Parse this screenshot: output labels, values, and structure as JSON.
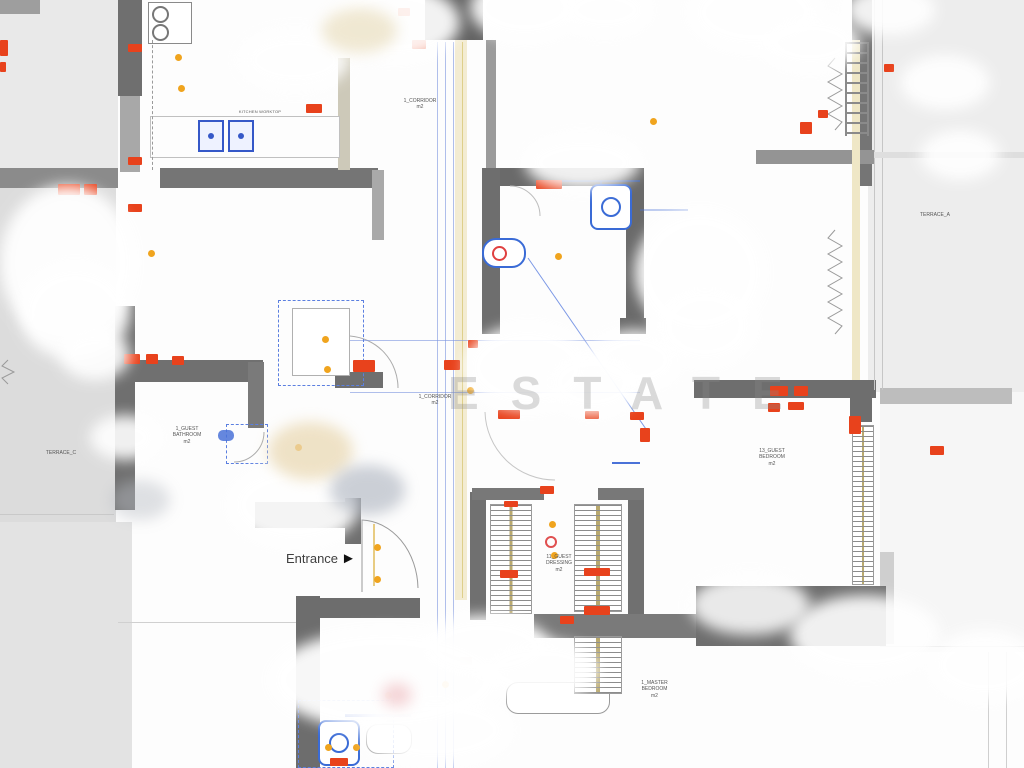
{
  "watermark": "ESTATE",
  "entrance": {
    "label": "Entrance",
    "arrow": "►"
  },
  "labels": {
    "corridor_upper": {
      "l1": "1_CORRIDOR",
      "l2": "m2"
    },
    "corridor_lower": {
      "l1": "1_CORRIDOR",
      "l2": "m2"
    },
    "terrace_a": {
      "l1": "TERRACE_A"
    },
    "terrace_c": {
      "l1": "TERRACE_C"
    },
    "guest_bathroom": {
      "l1": "1_GUEST",
      "l2": "BATHROOM",
      "l3": "m2"
    },
    "guest_bedroom": {
      "l1": "13_GUEST",
      "l2": "BEDROOM",
      "l3": "m2"
    },
    "guest_dressing": {
      "l1": "11_GUEST",
      "l2": "DRESSING",
      "l3": "m2"
    },
    "master_bedroom": {
      "l1": "1_MASTER",
      "l2": "BEDROOM",
      "l3": "m2"
    },
    "kitchen_note": {
      "l1": "KITCHEN WORKTOP"
    }
  },
  "colors": {
    "wall_gray": "#6e6e6e",
    "terrace_gray": "#dcdcdc",
    "annotation_red": "#e8421c",
    "plumbing_blue": "#3a6bd6",
    "light_orange": "#f0a41e",
    "corridor_beige": "#f3ecd2"
  }
}
